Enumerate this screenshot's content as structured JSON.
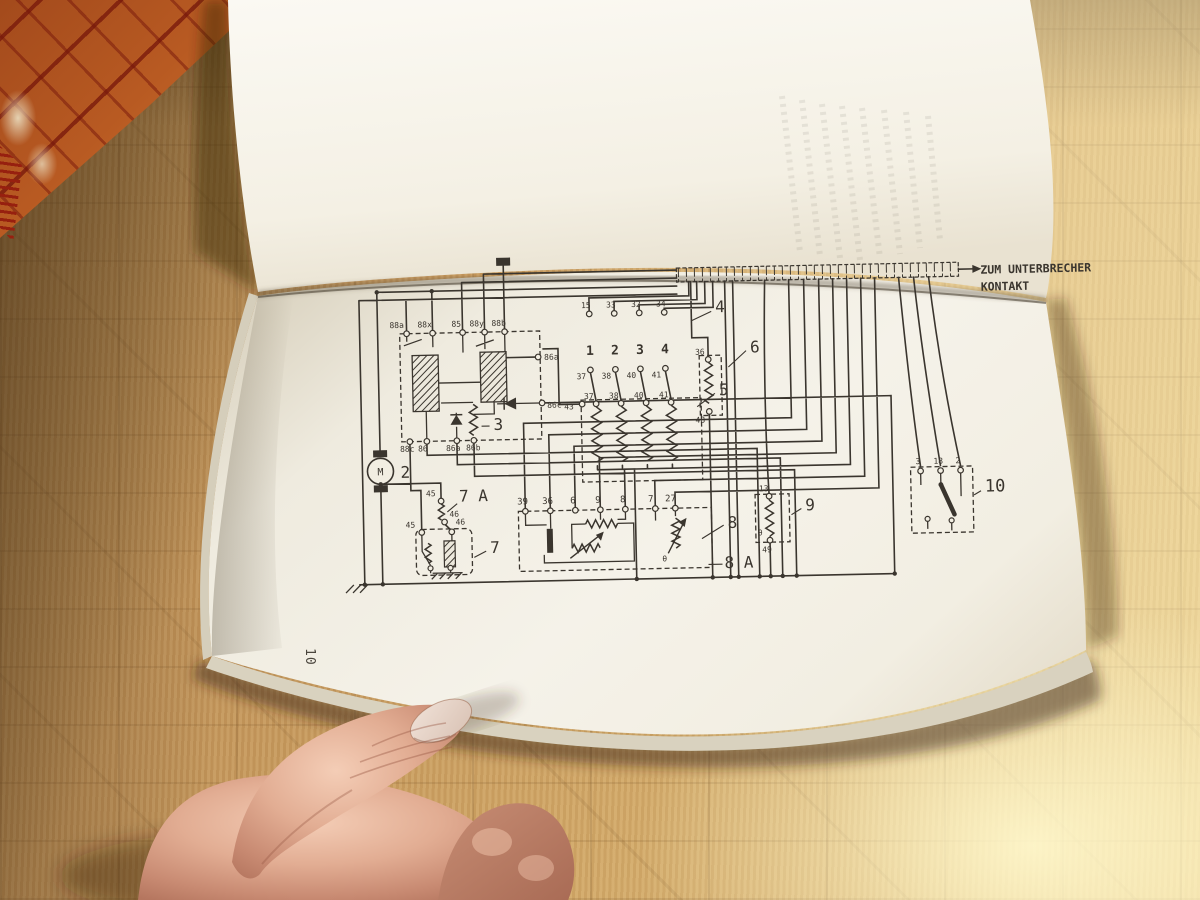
{
  "photo": {
    "subject": "open workshop manual with wiring diagram on parquet floor, held by a thumb",
    "colors": {
      "floor_mid": "#c79e62",
      "floor_sunlit": "#ecd9a0",
      "carpet_orange": "#b85a22",
      "carpet_red": "#7c1d10",
      "page_upper": "#f6f3ea",
      "page_lower": "#efebe0",
      "ink": "#3a352e",
      "skin": "#d9a48e"
    }
  },
  "book": {
    "page_number": "10",
    "diagram": {
      "annotation": {
        "line1": "ZUM UNTERBRECHER",
        "line2": "KONTAKT"
      },
      "motor_letter": "M",
      "components": {
        "c2": "2",
        "c3": "3",
        "c4": "4",
        "c5": "5",
        "c6": "6",
        "c7a": "7 A",
        "c7": "7",
        "c8": "8",
        "c8a": "8 A",
        "c9": "9",
        "c10": "10"
      },
      "switch_numbers": [
        "1",
        "2",
        "3",
        "4"
      ],
      "relay_top": [
        "88a",
        "88x",
        "85",
        "88y",
        "88b"
      ],
      "relay_right": [
        "86a",
        "86c"
      ],
      "relay_bottom": [
        "88c",
        "86",
        "86a",
        "86b"
      ],
      "switch_top": [
        "15",
        "33",
        "32",
        "34"
      ],
      "switch_bottom": [
        "37",
        "38",
        "40",
        "41"
      ],
      "resbank_top": [
        "37",
        "38",
        "40",
        "41"
      ],
      "resbank_left": "43",
      "res6_top": "36",
      "res6_bottom": "48",
      "c7a_terminals": [
        "45",
        "46"
      ],
      "c7_terminals": [
        "45",
        "46"
      ],
      "strip8": [
        "39",
        "36",
        "6",
        "9",
        "8",
        "7",
        "27"
      ],
      "c9_top": "13",
      "c9_bottom": "49",
      "theta": "θ",
      "c10_terminals": [
        "3",
        "18",
        "2"
      ]
    }
  }
}
